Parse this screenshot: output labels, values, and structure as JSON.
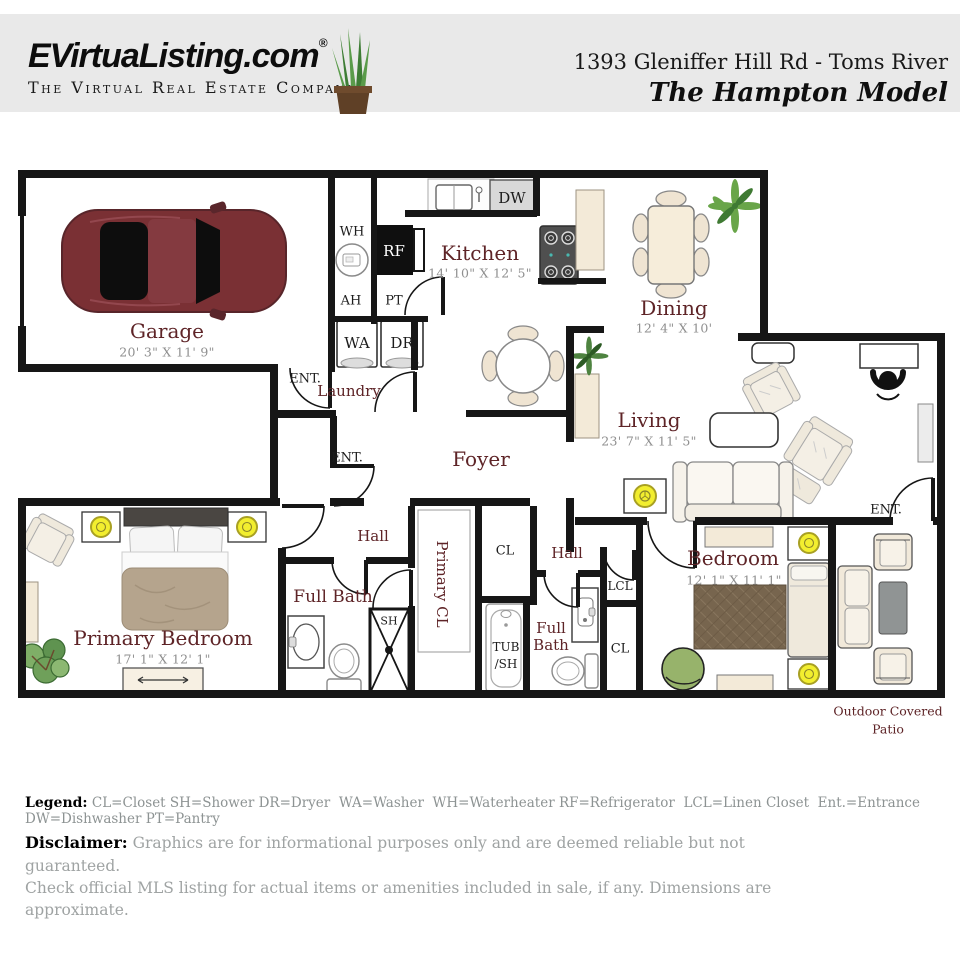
{
  "header": {
    "logo": "EVirtuaListing.com",
    "registered": "®",
    "tagline": "The Virtual Real Estate Company",
    "address": "1393 Gleniffer Hill Rd - Toms River",
    "model": "The Hampton Model"
  },
  "rooms": {
    "garage": {
      "name": "Garage",
      "dims": "20' 3\" X 11' 9\""
    },
    "kitchen": {
      "name": "Kitchen",
      "dims": "14' 10\" X 12' 5\""
    },
    "dining": {
      "name": "Dining",
      "dims": "12' 4\" X 10'"
    },
    "living": {
      "name": "Living",
      "dims": "23' 7\" X 11' 5\""
    },
    "foyer": {
      "name": "Foyer"
    },
    "laundry": {
      "name": "Laundry"
    },
    "hall_left": {
      "name": "Hall"
    },
    "hall_right": {
      "name": "Hall"
    },
    "primary_bedroom": {
      "name": "Primary Bedroom",
      "dims": "17' 1\" X 12' 1\""
    },
    "primary_bath": {
      "name": "Full Bath"
    },
    "primary_closet": {
      "name": "Primary CL"
    },
    "hall_bath": {
      "name": "Full Bath"
    },
    "bedroom": {
      "name": "Bedroom",
      "dims": "12' 1\" X 11' 1\""
    },
    "patio": {
      "line1": "Outdoor Covered",
      "line2": "Patio"
    }
  },
  "tags": {
    "wh": "WH",
    "ah": "AH",
    "rf": "RF",
    "pt": "PT",
    "wa": "WA",
    "dr": "DR",
    "dw": "DW",
    "sh": "SH",
    "tub": "TUB",
    "tub_sh": "/SH",
    "cl": "CL",
    "lcl": "LCL",
    "ent": "ENT."
  },
  "legend": {
    "title": "Legend:",
    "body": " CL=Closet SH=Shower DR=Dryer  WA=Washer  WH=Waterheater RF=Refrigerator  LCL=Linen Closet  Ent.=Entrance DW=Dishwasher PT=Pantry"
  },
  "disclaimer": {
    "title": "Disclaimer:",
    "line1": " Graphics are for informational purposes only and are deemed reliable but not guaranteed.",
    "line2": "Check official MLS listing for actual items or amenities included in sale, if any.  Dimensions are approximate."
  },
  "colors": {
    "wall": "#161616",
    "room_label_maroon": "#5e2427",
    "dim_gray": "#8f8f8f",
    "lamp_yellow": "#f2ee2f",
    "car_red": "#7a3034",
    "plant_green": "#69a549",
    "header_bg": "#e9e9e9",
    "counter_beige": "#f3ead8",
    "rug_brown": "#77654e"
  }
}
